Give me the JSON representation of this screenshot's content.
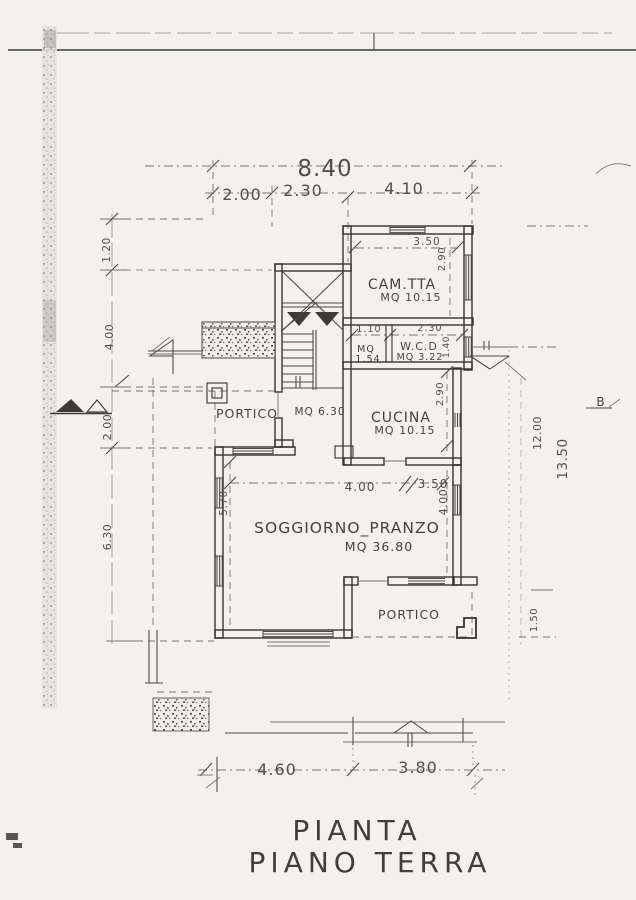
{
  "colors": {
    "paper": "#f2f1eb",
    "ink": "#45443f",
    "wall": "#35342e",
    "faint": "#76756d"
  },
  "title": {
    "line1": "PIANTA",
    "line2": "PIANO TERRA"
  },
  "rooms": {
    "cameretta": {
      "name": "CAM.TTA",
      "area": "MQ 10.15",
      "width": "3.50",
      "depth": "2.90"
    },
    "antibagno": {
      "name": "MQ",
      "area": "1.54",
      "width": "1.10"
    },
    "wc": {
      "name": "W.C.D",
      "area": "MQ 3.22",
      "width": "2.30",
      "depth": "1.40"
    },
    "cucina": {
      "name": "CUCINA",
      "area": "MQ 10.15",
      "depth": "2.90"
    },
    "portico_left": {
      "name": "PORTICO",
      "area": "MQ 6.30"
    },
    "soggiorno": {
      "name": "SOGGIORNO_PRANZO",
      "area": "MQ 36.80",
      "opening": "4.00",
      "right_width": "3.50",
      "left_depth": "5.70",
      "right_depth": "4.00"
    },
    "portico_bottom": {
      "name": "PORTICO"
    }
  },
  "dimensions": {
    "overall_width": "8.40",
    "top_segments": [
      "2.00",
      "2.30",
      "4.10"
    ],
    "left_side": [
      "1.20",
      "4.00",
      "2.00",
      "6.30"
    ],
    "right_side": [
      "12.00",
      "13.50",
      "1.50"
    ],
    "bottom_segments": [
      "4.60",
      "3.80"
    ]
  },
  "markers": {
    "section_b": "B"
  }
}
